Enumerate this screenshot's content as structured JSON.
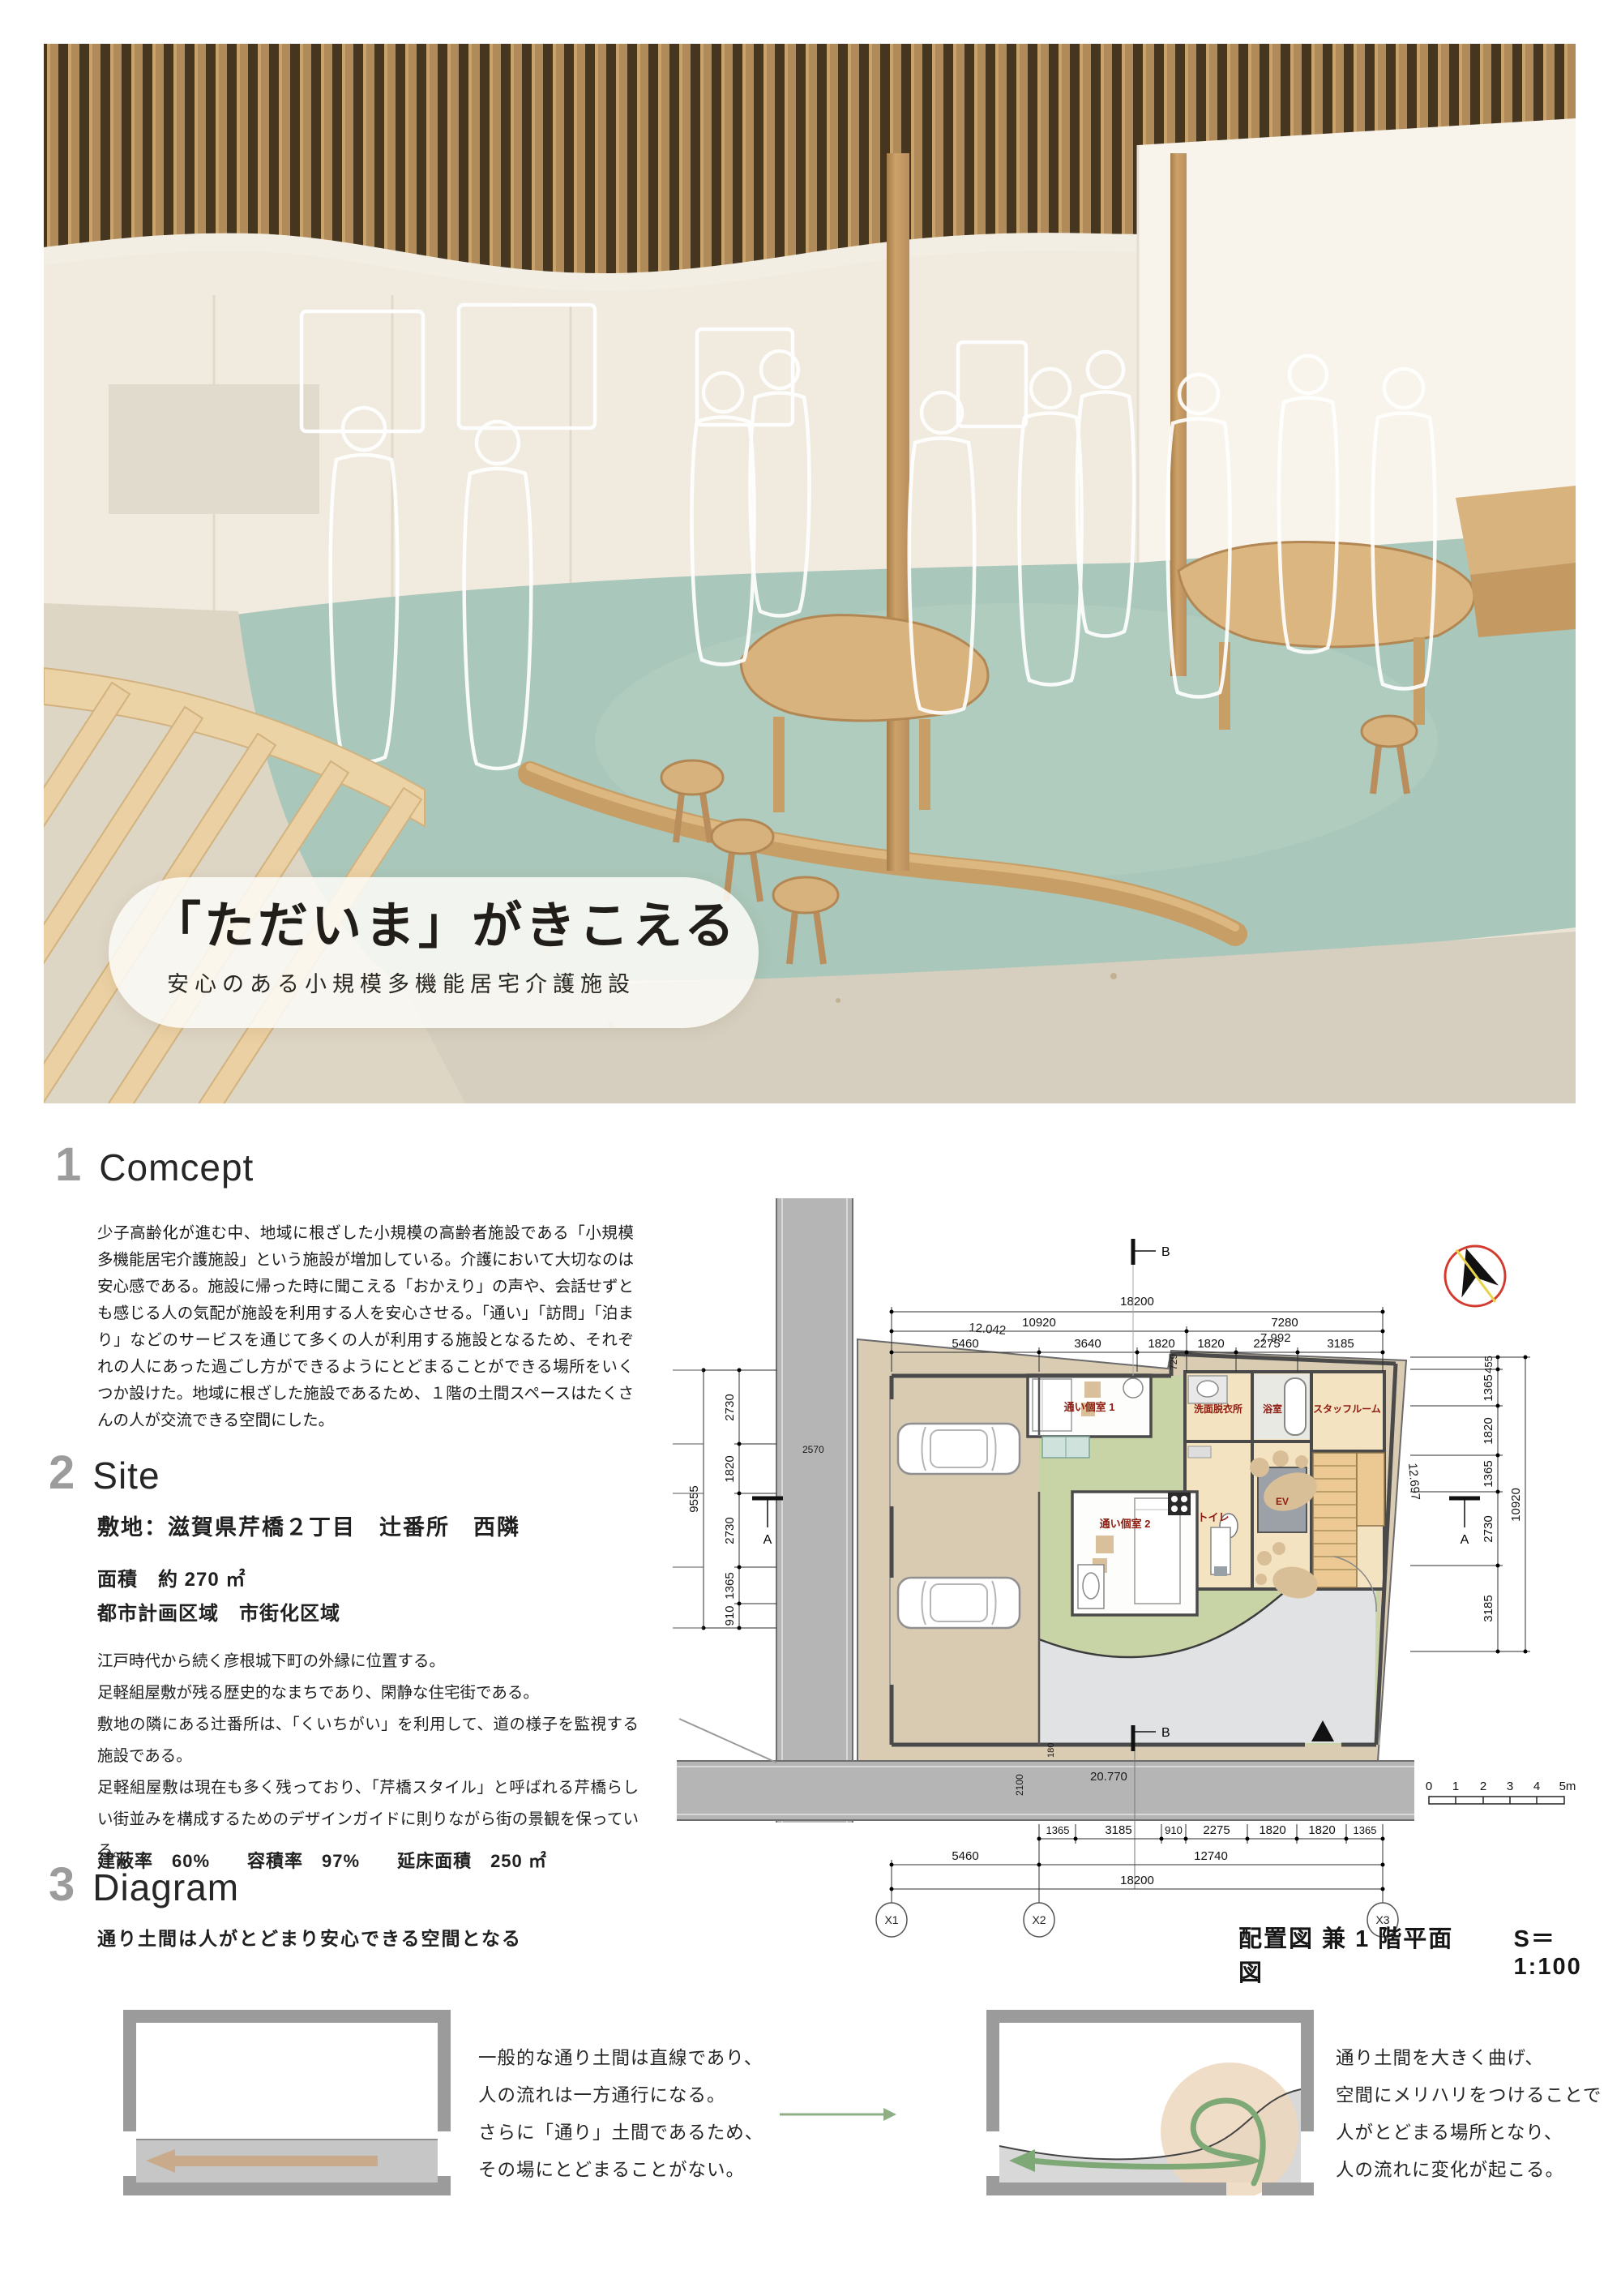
{
  "poster": {
    "title": "「ただいま」がきこえる",
    "subtitle": "安心のある小規模多機能居宅介護施設"
  },
  "concept": {
    "number": "1",
    "heading": "Comcept",
    "body": "少子高齢化が進む中、地域に根ざした小規模の高齢者施設である「小規模多機能居宅介護施設」という施設が増加している。介護において大切なのは安心感である。施設に帰った時に聞こえる「おかえり」の声や、会話せずとも感じる人の気配が施設を利用する人を安心させる。「通い」「訪問」「泊まり」などのサービスを通じて多くの人が利用する施設となるため、それぞれの人にあった過ごし方ができるようにとどまることができる場所をいくつか設けた。地域に根ざした施設であるため、１階の土間スペースはたくさんの人が交流できる空間にした。"
  },
  "site": {
    "number": "2",
    "heading": "Site",
    "location": "敷地：滋賀県芹橋２丁目　辻番所　西隣",
    "area": "面積　約 270 ㎡",
    "zoning": "都市計画区域　市街化区域",
    "body": [
      "江戸時代から続く彦根城下町の外縁に位置する。",
      "足軽組屋敷が残る歴史的なまちであり、閑静な住宅街である。",
      "敷地の隣にある辻番所は、「くいちがい」を利用して、道の様子を監視する施設である。",
      "足軽組屋敷は現在も多く残っており、「芹橋スタイル」と呼ばれる芹橋らしい街並みを構成するためのデザインガイドに則りながら街の景観を保っている。"
    ],
    "stats": "建蔽率　60%　　容積率　97%　　延床面積　250 ㎡"
  },
  "diagram": {
    "number": "3",
    "heading": "Diagram",
    "subtitle": "通り土間は人がとどまり安心できる空間となる",
    "left_caption": [
      "一般的な通り土間は直線であり、",
      "人の流れは一方通行になる。",
      "さらに「通り」土間であるため、",
      "その場にとどまることがない。"
    ],
    "right_caption": [
      "通り土間を大きく曲げ、",
      "空間にメリハリをつけることで",
      "人がとどまる場所となり、",
      "人の流れに変化が起こる。"
    ]
  },
  "plan": {
    "caption": "配置図 兼 1 階平面図",
    "scale": "S＝1:100",
    "grid_x": [
      "X1",
      "X2",
      "X3"
    ],
    "grid_y": [
      "Y5",
      "Y4",
      "Y3",
      "Y2",
      "Y1"
    ],
    "top": {
      "total": "18200",
      "mid": [
        "10920",
        "7280"
      ],
      "seg": [
        "5460",
        "3640",
        "1820",
        "1820",
        "2275",
        "3185"
      ]
    },
    "bottom": {
      "seg": [
        "1365",
        "3185",
        "910",
        "2275",
        "1820",
        "1820",
        "1365"
      ],
      "mid": [
        "5460",
        "12740"
      ],
      "total": "18200"
    },
    "left": {
      "total": "9555",
      "seg": [
        "2730",
        "1820",
        "2730",
        "1365",
        "910"
      ],
      "road": "2570"
    },
    "right": {
      "seg": [
        "455",
        "1365",
        "1820",
        "1365",
        "2730",
        "3185"
      ],
      "total": "10920",
      "edge": "12.697"
    },
    "site_edge": {
      "top_left": "12.042",
      "top_right": "7.992",
      "offset": "729",
      "road": "20.770",
      "road_w": "2100",
      "road_e": "180"
    },
    "markers": {
      "a": "A",
      "b": "B"
    },
    "rooms": {
      "kayoi1": "通い個室 1",
      "kayoi2": "通い個室 2",
      "senmen": "洗面脱衣所",
      "bath": "浴室",
      "staff": "スタッフルーム",
      "toilet": "トイレ",
      "ev": "EV"
    },
    "scalebar": [
      "0",
      "1",
      "2",
      "3",
      "4",
      "5m"
    ],
    "colors": {
      "room_label": "#8e1b10",
      "doma_green": "#c9d4a6",
      "site_tan": "#d9ccb3",
      "room_beige": "#f4e3c1",
      "road_gray": "#b5b5b5"
    }
  }
}
